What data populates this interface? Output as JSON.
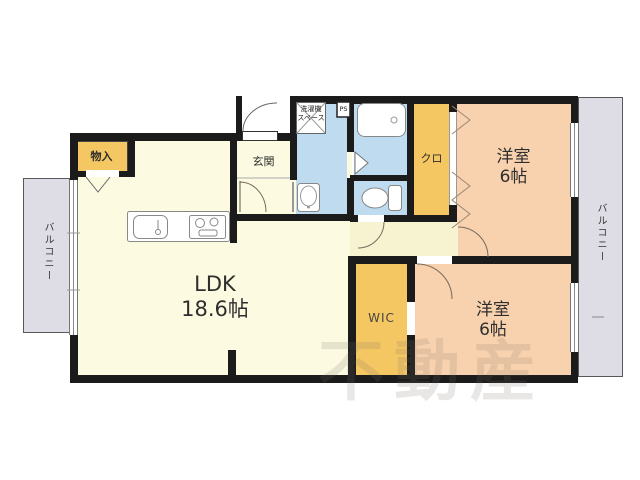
{
  "plan": {
    "ldk": {
      "label": "LDK",
      "size": "18.6帖"
    },
    "bedroom_top": {
      "label": "洋室",
      "size": "6帖"
    },
    "bedroom_bottom": {
      "label": "洋室",
      "size": "6帖"
    },
    "wic": {
      "label": "WIC"
    },
    "closet": {
      "label": "クロ"
    },
    "storage": {
      "label": "物入"
    },
    "entrance": {
      "label": "玄関"
    },
    "washer_space": {
      "line1": "洗濯機",
      "line2": "スペース"
    },
    "pipe_space": {
      "label": "PS"
    },
    "balcony_left": {
      "label": "バルコニー"
    },
    "balcony_right": {
      "label": "バルコニー"
    },
    "watermark": "不動産",
    "colors": {
      "room_cream": "#FCFAE1",
      "hall_cream": "#F7F2D0",
      "accent_orange": "#F5C763",
      "bedroom_peach": "#F8D2AE",
      "wet_blue": "#BFDBEF",
      "balcony_gray": "#DEDDE5",
      "wall_black": "#1B1B1B"
    }
  }
}
